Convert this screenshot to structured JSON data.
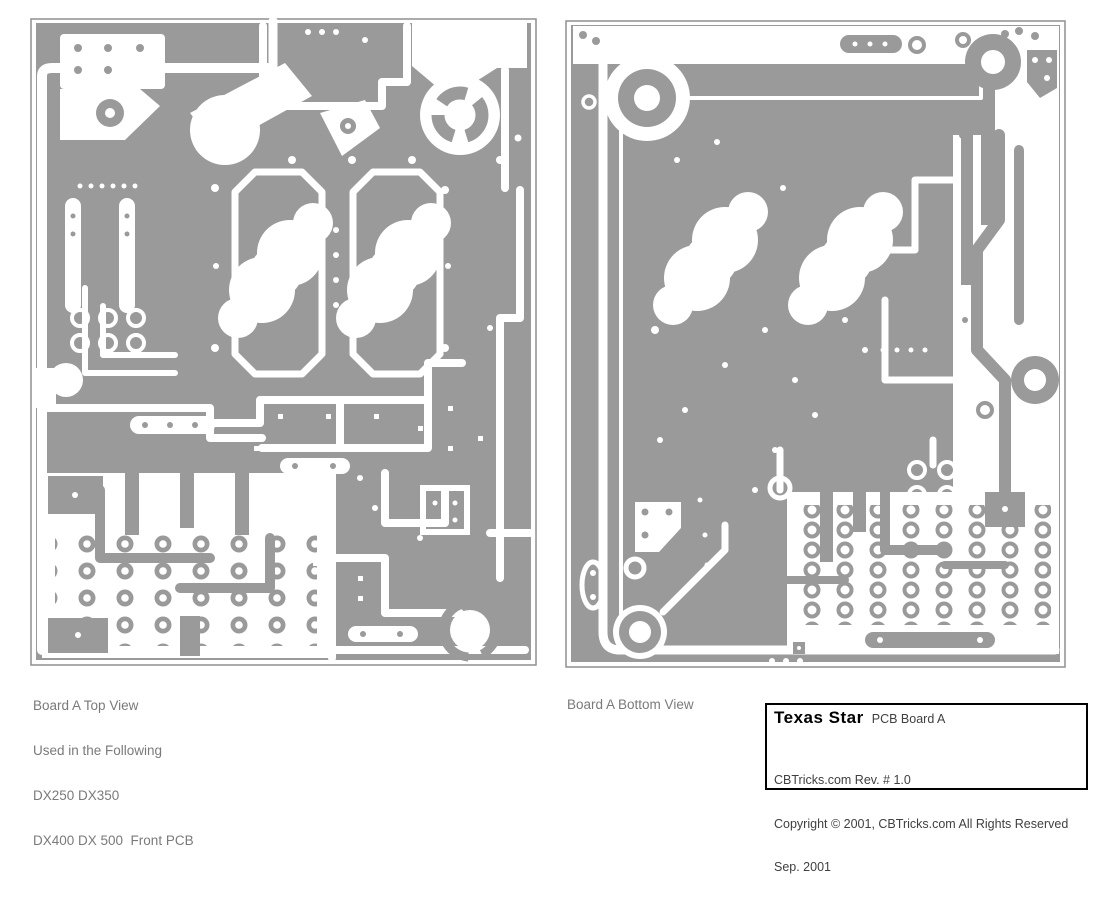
{
  "page": {
    "background": "#ffffff",
    "description": "Scanned PCB artwork sheet with two board views and a title block"
  },
  "colors": {
    "board_gray": "#9a9a9a",
    "trace_white": "#ffffff",
    "board_border": "#8f8f8f",
    "caption_text": "#7a7a7a",
    "title_text": "#404040",
    "brand_text": "#000000"
  },
  "captions": {
    "left": [
      "Board A Top View",
      "Used in the Following",
      "DX250 DX350",
      "DX400 DX 500  Front PCB"
    ],
    "right": [
      "Board A Bottom View"
    ]
  },
  "title_block": {
    "brand": "Texas Star",
    "board": "PCB Board A",
    "rev": "CBTricks.com Rev. # 1.0",
    "copyright": "Copyright © 2001, CBTricks.com All Rights Reserved",
    "date": "Sep. 2001"
  }
}
